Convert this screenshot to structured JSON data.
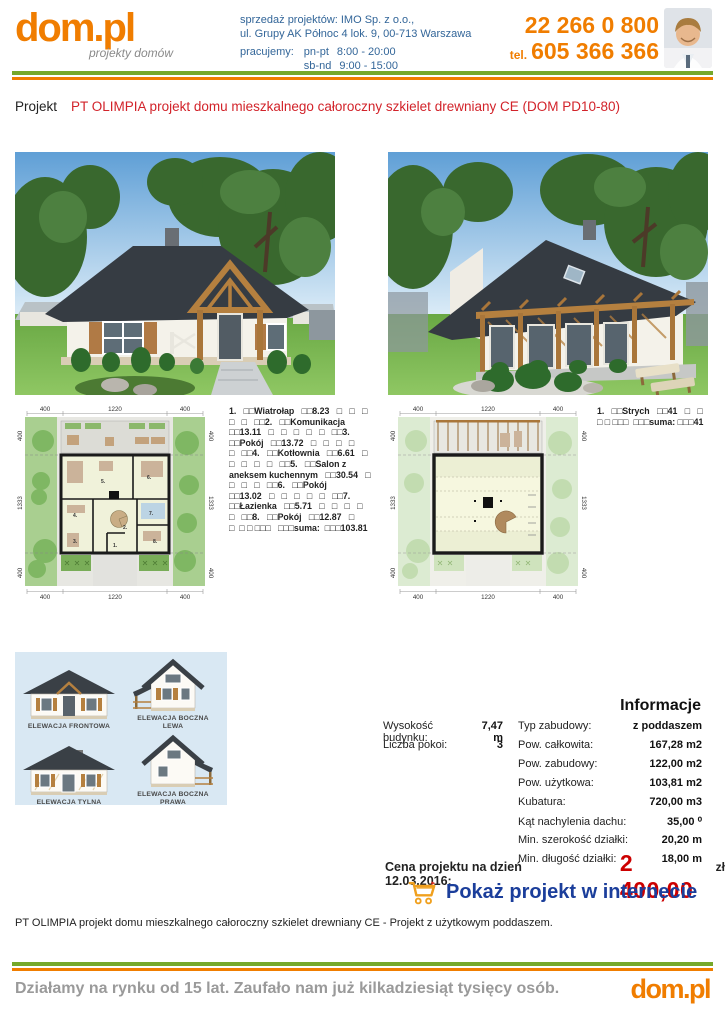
{
  "header": {
    "logo_text": "dom.pl",
    "logo_tagline": "projekty domów",
    "sales_line1": "sprzedaż projektów: IMO Sp. z o.o.,",
    "sales_line2": "ul. Grupy AK Północ 4 lok. 9, 00-713 Warszawa",
    "hours_label": "pracujemy:",
    "hours_weekdays_label": "pn-pt",
    "hours_weekdays": "8:00 - 20:00",
    "hours_weekend_label": "sb-nd",
    "hours_weekend": "9:00 - 15:00",
    "phone_primary": "22 266 0 800",
    "phone_tel_label": "tel.",
    "phone_secondary": "605 366 366"
  },
  "title": {
    "label": "Projekt",
    "text": "PT OLIMPIA projekt domu mieszkalnego całoroczny szkielet drewniany CE (DOM PD10-80)"
  },
  "site_dims": {
    "top": [
      "400",
      "1220",
      "400"
    ],
    "side": [
      "400",
      "1333",
      "400"
    ],
    "bottom": [
      "400",
      "1220",
      "400"
    ]
  },
  "plans": {
    "room_numbers": [
      "1.",
      "2.",
      "3.",
      "4.",
      "5.",
      "6.",
      "7.",
      "8."
    ],
    "ground_rooms_text": "1.   □□Wiatrołap   □□8.23   □   □   □\n□   □   □□2.   □□Komunikacja\n□□13.11   □   □   □   □   □   □□3.\n□□Pokój   □□13.72   □   □   □   □\n□   □□4.   □□Kotłownia   □□6.61   □\n□   □   □   □   □□5.   □□Salon z\naneksem kuchennym   □□30.54   □\n□   □   □   □□6.   □□Pokój\n□□13.02   □   □   □   □   □   □□7.\n□□Łazienka   □□5.71   □   □   □   □\n□   □□8.   □□Pokój   □□12.87   □\n□  □ □ □□□   □□□suma:  □□□103.81",
    "attic_rooms_text": "1.   □□Strych   □□41   □   □\n□ □ □□□  □□□suma: □□□41"
  },
  "elevations": {
    "labels": [
      "ELEWACJA FRONTOWA",
      "ELEWACJA BOCZNA LEWA",
      "ELEWACJA TYLNA",
      "ELEWACJA BOCZNA PRAWA"
    ]
  },
  "info": {
    "heading": "Informacje",
    "left_specs": [
      {
        "label": "Wysokość budynku:",
        "value": "7,47 m"
      },
      {
        "label": "Liczba pokoi:",
        "value": "3"
      }
    ],
    "specs": [
      {
        "label": "Typ zabudowy:",
        "value": "z poddaszem"
      },
      {
        "label": "Pow. całkowita:",
        "value": "167,28 m2"
      },
      {
        "label": "Pow. zabudowy:",
        "value": "122,00 m2"
      },
      {
        "label": "Pow. użytkowa:",
        "value": "103,81 m2"
      },
      {
        "label": "Kubatura:",
        "value": "720,00 m3"
      },
      {
        "label": "Kąt nachylenia dachu:",
        "value": "35,00 ⁰"
      },
      {
        "label": "Min. szerokość działki:",
        "value": "20,20 m"
      },
      {
        "label": "Min. długość działki:",
        "value": "18,00 m"
      }
    ]
  },
  "price": {
    "label": "Cena projektu na dzień 12.03.2016:",
    "value": "2 400,00",
    "currency": "zł"
  },
  "cta": {
    "label": "Pokaż projekt w internecie",
    "cart_icon": "shopping-cart"
  },
  "description": "PT OLIMPIA projekt domu mieszkalnego całoroczny szkielet drewniany CE - Projekt z użytkowym poddaszem.",
  "footer": {
    "tagline": "Działamy na rynku od 15 lat. Zaufało nam już kilkadziesiąt tysięcy osób.",
    "logo_text": "dom.pl"
  },
  "colors": {
    "accent_orange": "#f07d00",
    "bar_green": "#76a82a",
    "title_red": "#d2232a",
    "price_red": "#cc0000",
    "link_blue": "#1b3e9b",
    "header_blue": "#336699"
  }
}
